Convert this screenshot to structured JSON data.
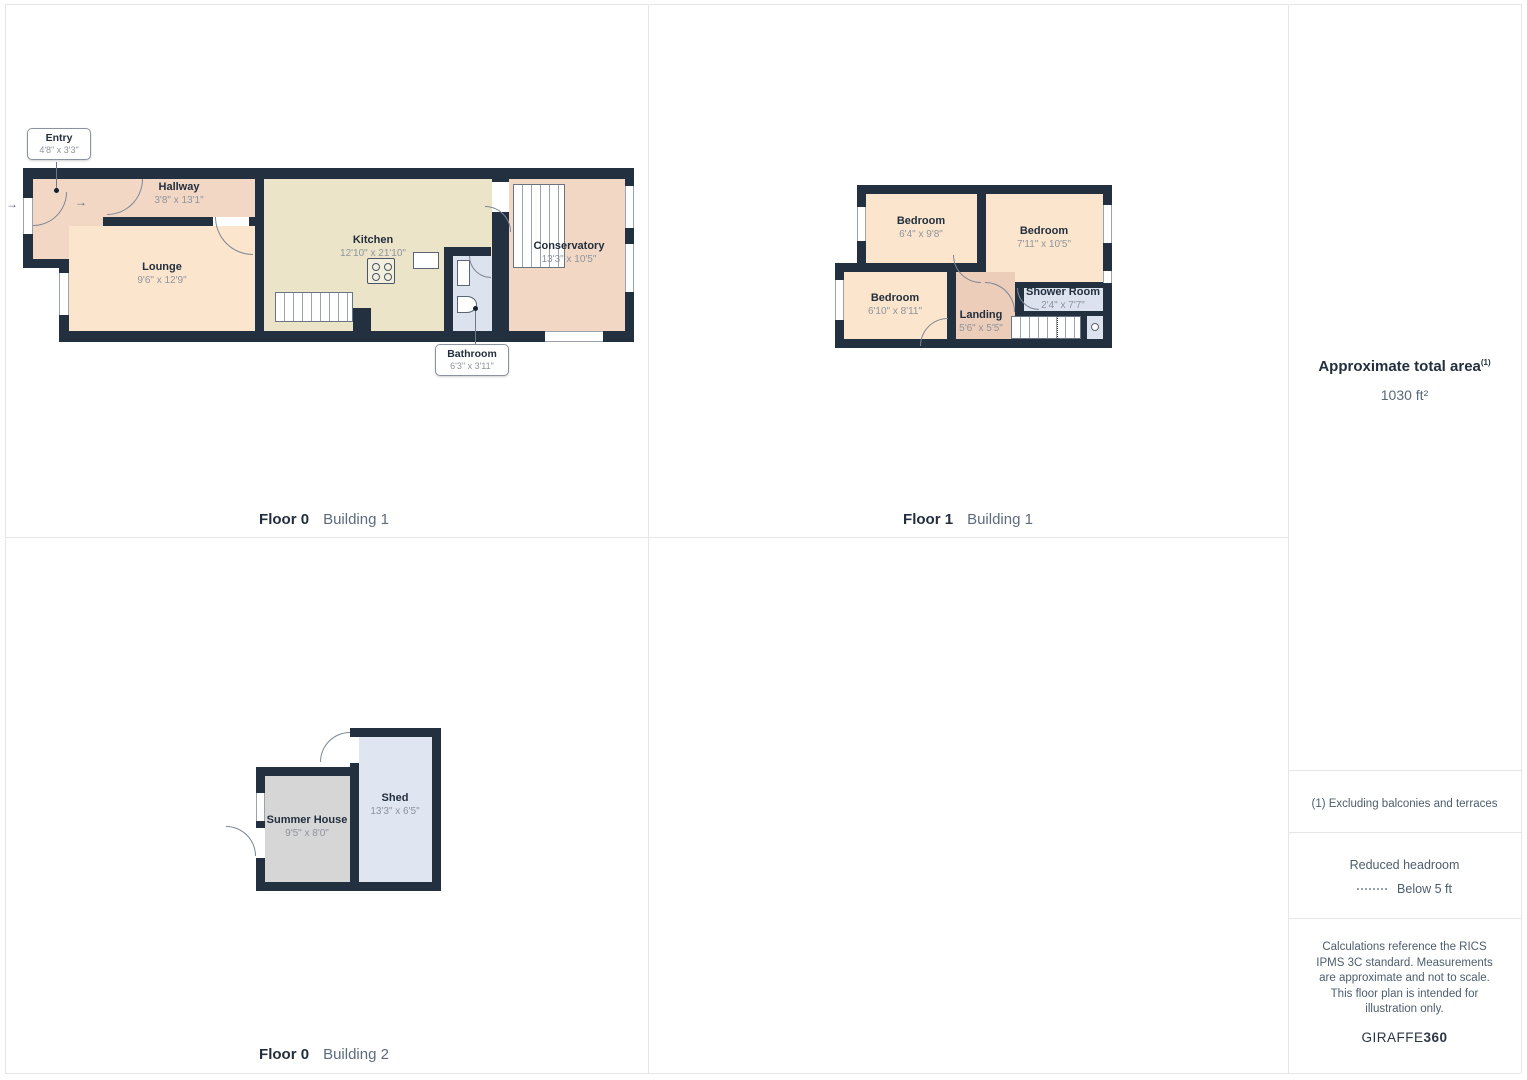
{
  "plans": [
    {
      "caption_floor": "Floor 0",
      "caption_building": "Building 1",
      "rooms": [
        {
          "name": "Entry",
          "dims": "4'8\" x 3'3\""
        },
        {
          "name": "Hallway",
          "dims": "3'8\" x 13'1\""
        },
        {
          "name": "Lounge",
          "dims": "9'6\" x 12'9\""
        },
        {
          "name": "Kitchen",
          "dims": "12'10\" x 21'10\""
        },
        {
          "name": "Bathroom",
          "dims": "6'3\" x 3'11\""
        },
        {
          "name": "Conservatory",
          "dims": "13'3\" x 10'5\""
        }
      ]
    },
    {
      "caption_floor": "Floor 1",
      "caption_building": "Building 1",
      "rooms": [
        {
          "name": "Bedroom",
          "dims": "6'4\" x 9'8\""
        },
        {
          "name": "Bedroom",
          "dims": "7'11\" x 10'5\""
        },
        {
          "name": "Bedroom",
          "dims": "6'10\" x 8'11\""
        },
        {
          "name": "Landing",
          "dims": "5'6\" x 5'5\""
        },
        {
          "name": "Shower Room",
          "dims": "2'4\" x 7'7\""
        }
      ]
    },
    {
      "caption_floor": "Floor 0",
      "caption_building": "Building 2",
      "rooms": [
        {
          "name": "Summer House",
          "dims": "9'5\" x 8'0\""
        },
        {
          "name": "Shed",
          "dims": "13'3\" x 6'5\""
        }
      ]
    }
  ],
  "sidebar": {
    "total_area_title": "Approximate total area",
    "total_area_sup": "(1)",
    "total_area_value": "1030 ft²",
    "footnote": "(1) Excluding balconies and terraces",
    "reduced_headroom_title": "Reduced headroom",
    "reduced_headroom_legend": "Below 5 ft",
    "disclaimer": "Calculations reference the RICS IPMS 3C standard. Measurements are approximate and not to scale. This floor plan is intended for illustration only.",
    "brand_name": "GIRAFFE",
    "brand_suffix": "360"
  },
  "entry_arrow": "→",
  "colors": {
    "wall": "#22303f",
    "room_peach": "#f2d7c5",
    "room_light_peach": "#fce5cd",
    "room_tan": "#ece4c8",
    "room_blue_gray": "#dce2ee",
    "room_dark_peach": "#eccdb9",
    "room_gray": "#d6d6d6",
    "room_shed_blue": "#e0e6f1",
    "text_dark": "#232f3e",
    "text_dim_gray": "#8e949e",
    "grid_border": "#e6e6e6"
  }
}
